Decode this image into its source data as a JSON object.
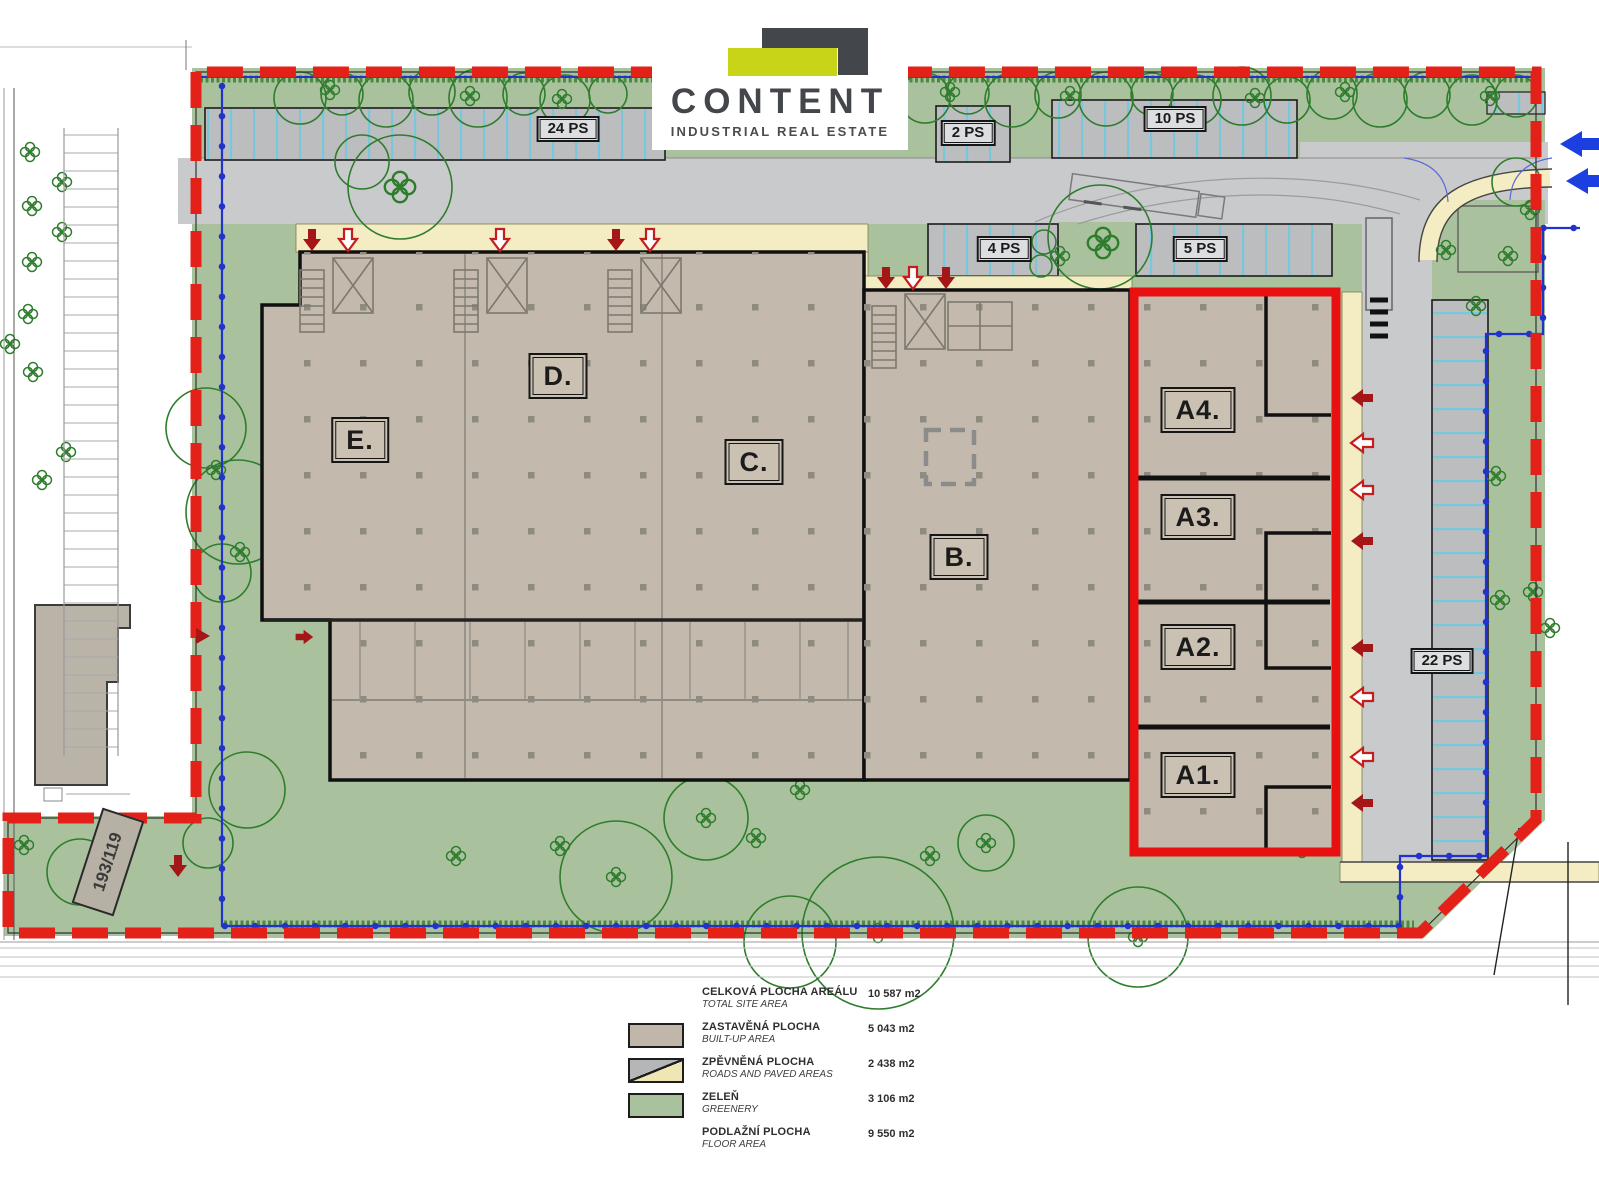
{
  "logo": {
    "name": "CONTENT",
    "tagline": "INDUSTRIAL REAL ESTATE"
  },
  "plan": {
    "buildings": [
      {
        "id": "E",
        "label": "E."
      },
      {
        "id": "D",
        "label": "D."
      },
      {
        "id": "C",
        "label": "C."
      },
      {
        "id": "B",
        "label": "B."
      },
      {
        "id": "A4",
        "label": "A4."
      },
      {
        "id": "A3",
        "label": "A3."
      },
      {
        "id": "A2",
        "label": "A2."
      },
      {
        "id": "A1",
        "label": "A1."
      }
    ],
    "parking": [
      {
        "label": "24 PS"
      },
      {
        "label": "2 PS"
      },
      {
        "label": "10 PS"
      },
      {
        "label": "4 PS"
      },
      {
        "label": "5 PS"
      },
      {
        "label": "22 PS"
      }
    ],
    "parcel_label": "193/119"
  },
  "legend": {
    "rows": [
      {
        "label_cs": "CELKOVÁ PLOCHA AREÁLU",
        "label_en": "TOTAL SITE AREA",
        "value": "10 587 m2",
        "swatch": "none"
      },
      {
        "label_cs": "ZASTAVĚNÁ PLOCHA",
        "label_en": "BUILT-UP AREA",
        "value": "5 043 m2",
        "swatch": "built-up"
      },
      {
        "label_cs": "ZPĚVNĚNÁ PLOCHA",
        "label_en": "ROADS AND PAVED AREAS",
        "value": "2 438 m2",
        "swatch": "paved"
      },
      {
        "label_cs": "ZELEŇ",
        "label_en": "GREENERY",
        "value": "3 106 m2",
        "swatch": "greenery"
      },
      {
        "label_cs": "PODLAŽNÍ PLOCHA",
        "label_en": "FLOOR AREA",
        "value": "9 550 m2",
        "swatch": "none"
      }
    ]
  },
  "colors": {
    "boundary_red": "#e32119",
    "unit_outline_red": "#e81010",
    "built_up_tan": "#c3b9ac",
    "greenery_green": "#a9c29d",
    "road_gray": "#c9cacc",
    "parking_gray": "#bcbdbf",
    "walkway_yellow": "#f4ecc3",
    "parking_divider_blue": "#79c7dd",
    "utility_blue": "#2233cc",
    "entry_arrow_blue": "#1b3fe0",
    "door_arrow_red": "#a51717",
    "logo_dark": "#43464a",
    "logo_green": "#c8d418"
  }
}
